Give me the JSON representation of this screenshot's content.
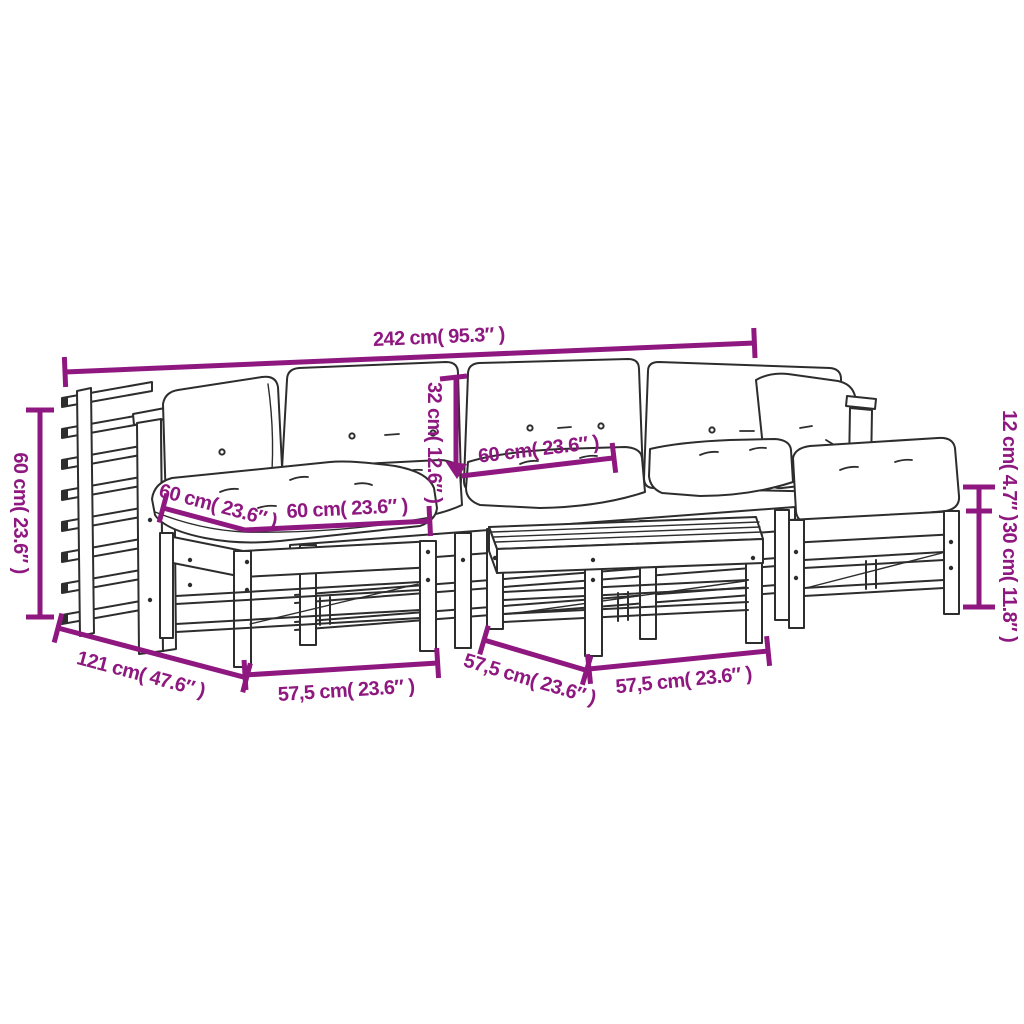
{
  "diagram": {
    "background_color": "#ffffff",
    "accent_color": "#8E1880",
    "line_color": "#2d2d2d",
    "dimensions": {
      "total_width": "242 cm( 95.3″ )",
      "armrest_height": "60 cm( 23.6″ )",
      "total_depth": "121 cm( 47.6″ )",
      "left_module_width": "57,5 cm( 23.6″ )",
      "table_depth": "57,5 cm( 23.6″ )",
      "table_width": "57,5 cm( 23.6″ )",
      "backrest_height": "32 cm( 12.6″ )",
      "backrest_width": "60 cm( 23.6″ )",
      "seat_depth": "60 cm( 23.6″ )",
      "seat_width": "60 cm( 23.6″ )",
      "cushion_thickness": "12 cm( 4.7″ )",
      "frame_height": "30 cm( 11.8″ )"
    }
  }
}
